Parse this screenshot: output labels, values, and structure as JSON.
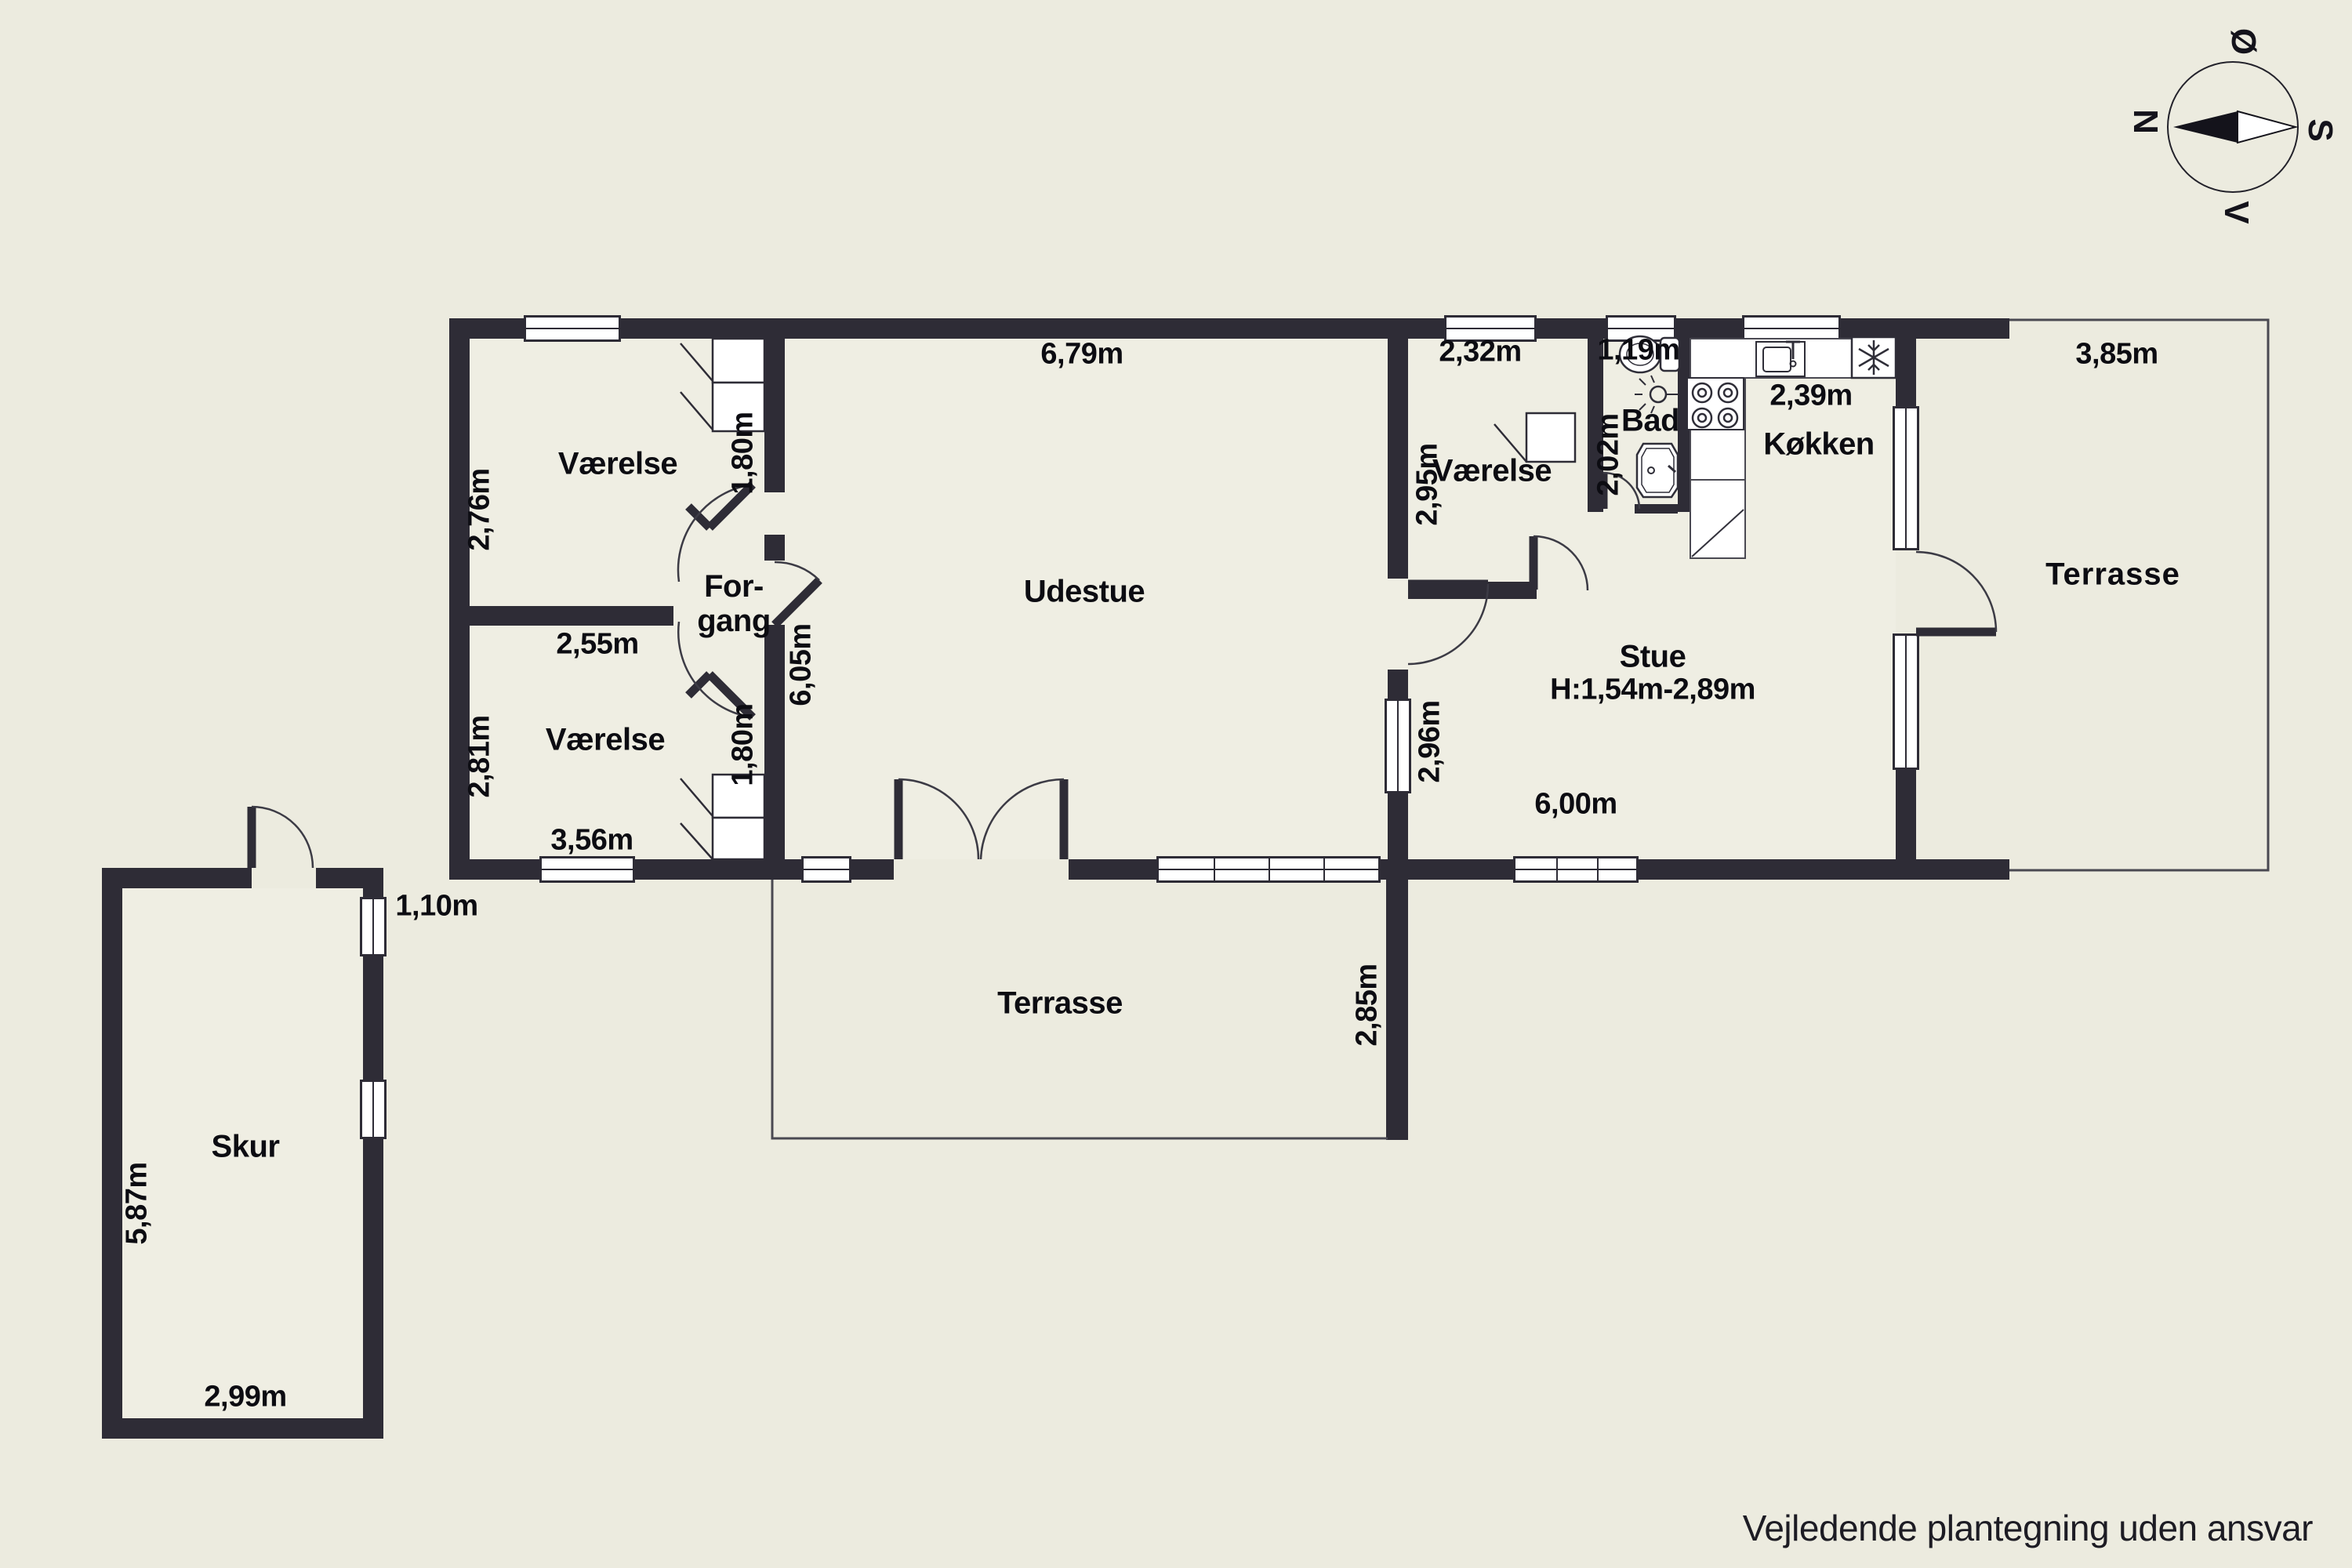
{
  "page": {
    "background": "#ecebdf",
    "wall_color": "#2e2c36",
    "footer_note": "Vejledende plantegning uden ansvar"
  },
  "compass": {
    "north": "N",
    "east": "Ø",
    "south": "S",
    "west": "V"
  },
  "icons": {
    "compass": "compass-rose-icon",
    "freezer": "snowflake-icon",
    "bad": [
      "toilet-icon",
      "ceiling-lamp-icon",
      "washbasin-icon"
    ],
    "koekken": [
      "kitchen-sink-icon",
      "stove-burners-icon"
    ],
    "closets": "wardrobe-icon"
  },
  "rooms": {
    "vaerelse_nw": {
      "name": "Værelse",
      "wall_width": "2,55m",
      "depth": "2,76m",
      "closet_width": "1,80m"
    },
    "vaerelse_sw": {
      "name": "Værelse",
      "width": "3,56m",
      "depth": "2,81m",
      "closet_width": "1,80m"
    },
    "forgang": {
      "line1": "For-",
      "line2": "gang"
    },
    "udestue": {
      "name": "Udestue",
      "width": "6,79m",
      "depth": "6,05m"
    },
    "vaerelse_mid": {
      "name": "Værelse",
      "width": "2,32m",
      "depth": "2,95m"
    },
    "bad": {
      "name": "Bad",
      "width": "1,19m",
      "depth": "2,02m"
    },
    "koekken": {
      "name": "Køkken",
      "width": "2,39m"
    },
    "stue": {
      "name": "Stue",
      "ceiling_height": "H:1,54m-2,89m",
      "window_width": "2,96m",
      "width": "6,00m"
    },
    "terrasse_east": {
      "name": "Terrasse",
      "width": "3,85m"
    },
    "terrasse_south": {
      "name": "Terrasse",
      "depth": "2,85m"
    },
    "skur": {
      "name": "Skur",
      "depth": "5,87m",
      "width": "2,99m",
      "door_width": "1,10m"
    }
  }
}
